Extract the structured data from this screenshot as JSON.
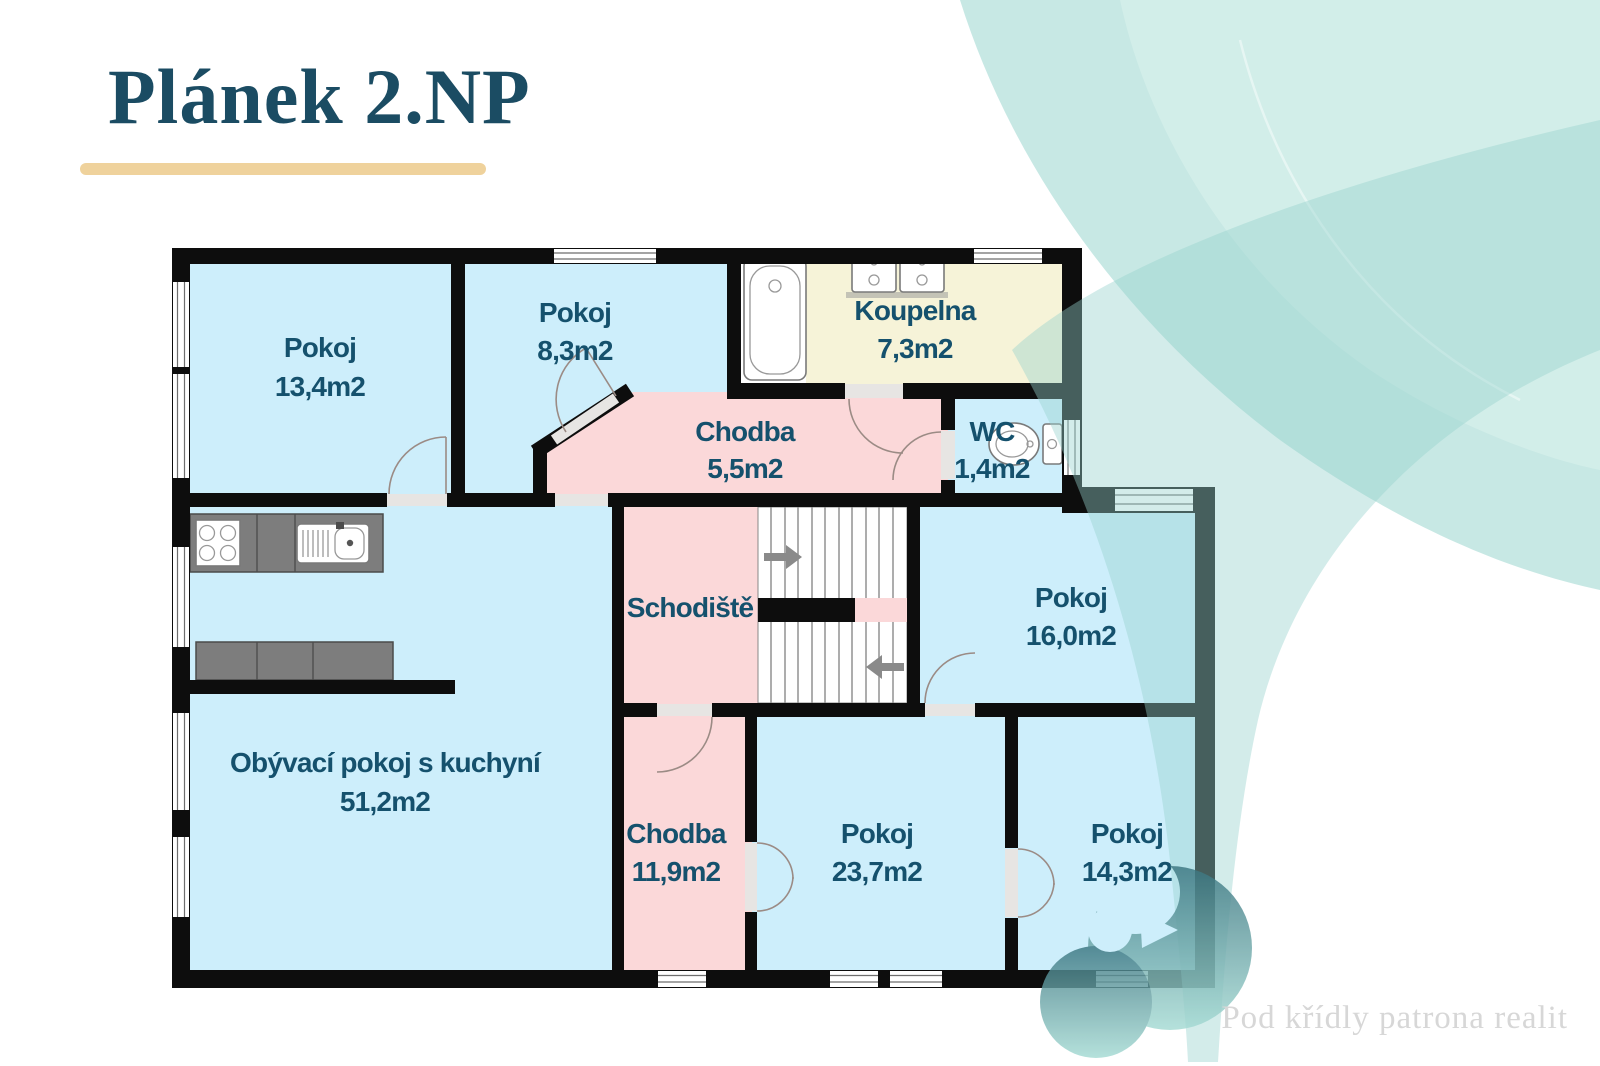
{
  "slide": {
    "title": "Plánek 2.NP",
    "brand": "Pod křídly patrona realit"
  },
  "floorplan": {
    "rooms": [
      {
        "name": "Pokoj",
        "area": "13,4m2"
      },
      {
        "name": "Pokoj",
        "area": "8,3m2"
      },
      {
        "name": "Koupelna",
        "area": "7,3m2"
      },
      {
        "name": "Chodba",
        "area": "5,5m2"
      },
      {
        "name": "WC",
        "area": "1,4m2"
      },
      {
        "name": "Schodiště",
        "area": ""
      },
      {
        "name": "Pokoj",
        "area": "16,0m2"
      },
      {
        "name": "Obývací pokoj s kuchyní",
        "area": "51,2m2"
      },
      {
        "name": "Chodba",
        "area": "11,9m2"
      },
      {
        "name": "Pokoj",
        "area": "23,7m2"
      },
      {
        "name": "Pokoj",
        "area": "14,3m2"
      }
    ],
    "fixtures": [
      "bathtub",
      "washbasin",
      "washbasin",
      "toilet",
      "kitchen-stove",
      "kitchen-sink",
      "stairs-up-arrow",
      "stairs-down-arrow"
    ],
    "colors": {
      "room_fill": "#cdeefb",
      "corridor_fill": "#fbd8d9",
      "bathroom_fill": "#f6f3d8",
      "wall": "#0d0d0d",
      "label_text": "#15516d"
    }
  },
  "decor": {
    "title_color": "#1b4c63",
    "underline_color": "#efd29c",
    "swirl_color": "#c7e8e4",
    "brand_text_color": "#d7d7d7"
  }
}
